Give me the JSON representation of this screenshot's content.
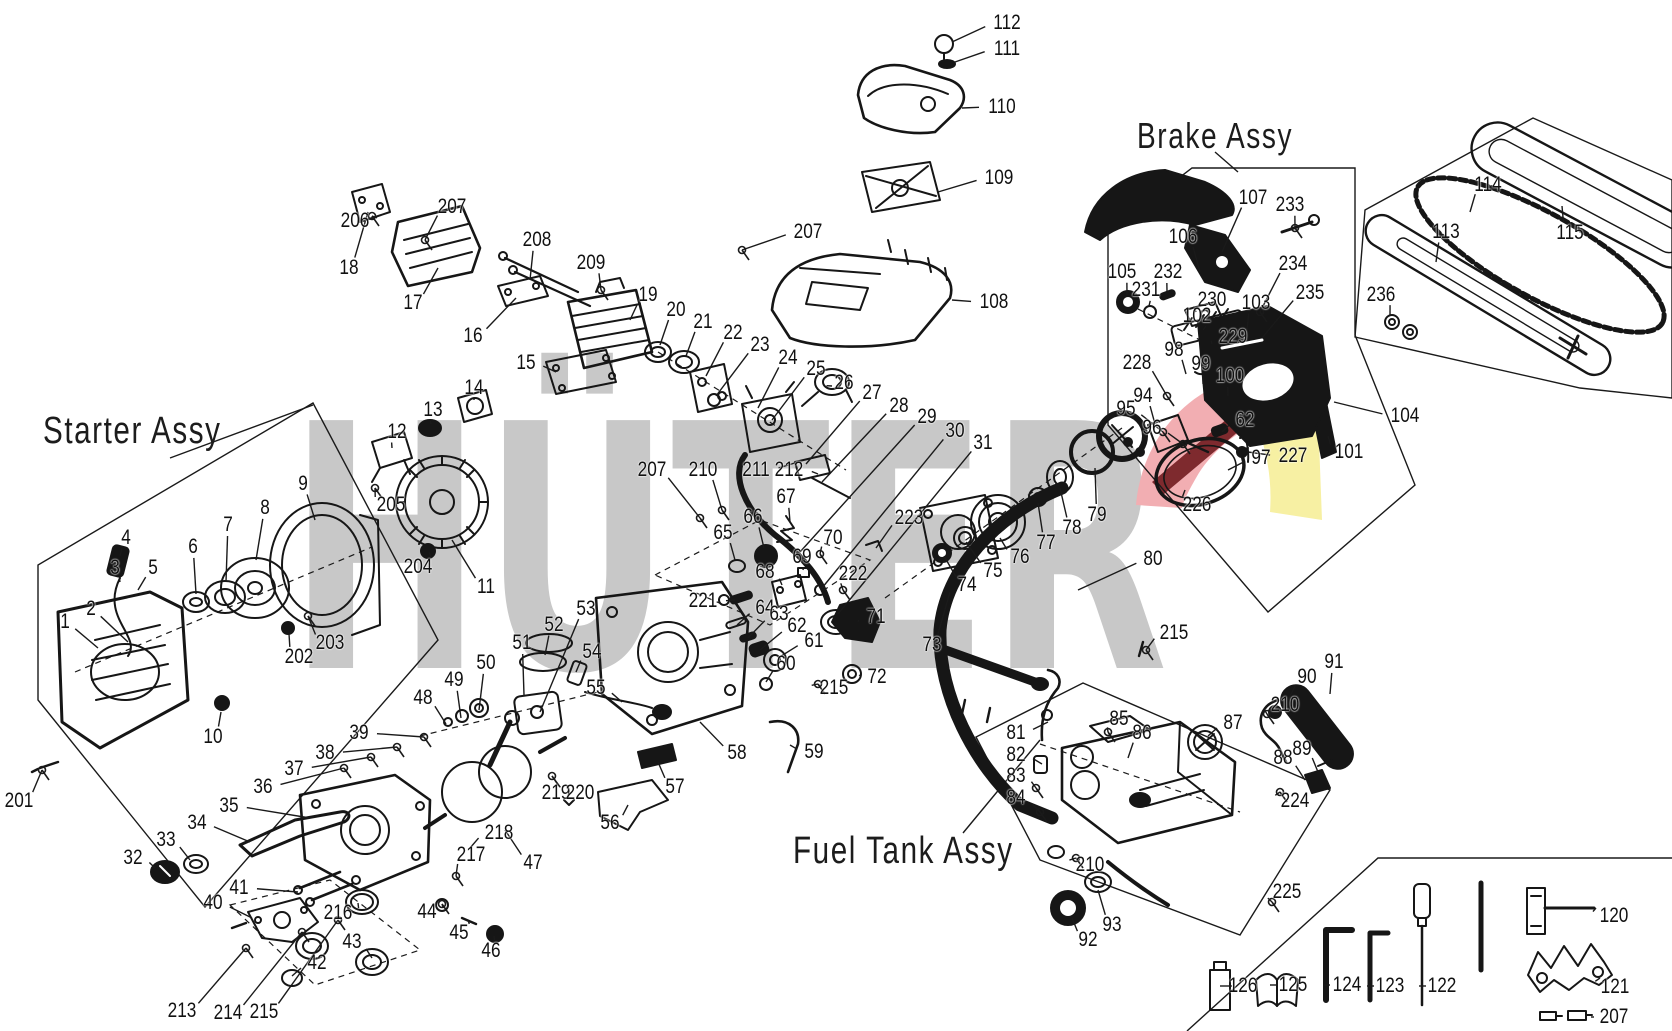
{
  "titles": {
    "starter": "Starter Assy",
    "brake": "Brake Assy",
    "fuel": "Fuel Tank Assy"
  },
  "watermark": {
    "text": "HÜTER"
  },
  "colors": {
    "watermark_gray": "#c8c8c8",
    "accent_red_light": "#f2aeb2",
    "accent_red_dark": "#7e2a2e",
    "accent_yellow": "#f7f0a3",
    "line": "#1a1a1a"
  },
  "callouts": [
    {
      "n": "1",
      "x": 65,
      "y": 622,
      "tx": 98,
      "ty": 648
    },
    {
      "n": "2",
      "x": 91,
      "y": 609,
      "tx": 128,
      "ty": 642
    },
    {
      "n": "3",
      "x": 115,
      "y": 568,
      "tx": 120,
      "ty": 582
    },
    {
      "n": "4",
      "x": 126,
      "y": 538,
      "tx": 120,
      "ty": 556
    },
    {
      "n": "5",
      "x": 153,
      "y": 568,
      "tx": 138,
      "ty": 590
    },
    {
      "n": "6",
      "x": 193,
      "y": 547,
      "tx": 196,
      "ty": 594
    },
    {
      "n": "7",
      "x": 228,
      "y": 525,
      "tx": 226,
      "ty": 582
    },
    {
      "n": "8",
      "x": 265,
      "y": 508,
      "tx": 256,
      "ty": 560
    },
    {
      "n": "9",
      "x": 303,
      "y": 484,
      "tx": 315,
      "ty": 520
    },
    {
      "n": "10",
      "x": 213,
      "y": 737,
      "tx": 221,
      "ty": 712
    },
    {
      "n": "11",
      "x": 486,
      "y": 587,
      "tx": 452,
      "ty": 540
    },
    {
      "n": "12",
      "x": 397,
      "y": 432,
      "tx": 392,
      "ty": 448
    },
    {
      "n": "13",
      "x": 433,
      "y": 410,
      "tx": 431,
      "ty": 424
    },
    {
      "n": "14",
      "x": 474,
      "y": 388,
      "tx": 474,
      "ty": 400
    },
    {
      "n": "201",
      "x": 19,
      "y": 801,
      "tx": 42,
      "ty": 770,
      "s": 1
    },
    {
      "n": "202",
      "x": 299,
      "y": 657,
      "tx": 289,
      "ty": 634
    },
    {
      "n": "203",
      "x": 330,
      "y": 643,
      "tx": 308,
      "ty": 616,
      "s": 1
    },
    {
      "n": "204",
      "x": 418,
      "y": 567,
      "tx": 429,
      "ty": 552
    },
    {
      "n": "205",
      "x": 391,
      "y": 505,
      "tx": 375,
      "ty": 488,
      "s": 1
    },
    {
      "n": "206",
      "x": 355,
      "y": 221,
      "tx": 372,
      "ty": 216,
      "s": 1
    },
    {
      "n": "207",
      "x": 452,
      "y": 207,
      "tx": 425,
      "ty": 240,
      "s": 1
    },
    {
      "n": "18",
      "x": 349,
      "y": 268,
      "tx": 368,
      "ty": 212
    },
    {
      "n": "17",
      "x": 413,
      "y": 303,
      "tx": 438,
      "ty": 268
    },
    {
      "n": "208",
      "x": 537,
      "y": 240,
      "tx": 530,
      "ty": 280
    },
    {
      "n": "16",
      "x": 473,
      "y": 336,
      "tx": 516,
      "ty": 298
    },
    {
      "n": "209",
      "x": 591,
      "y": 263,
      "tx": 601,
      "ty": 290,
      "s": 1
    },
    {
      "n": "19",
      "x": 648,
      "y": 295,
      "tx": 630,
      "ty": 320
    },
    {
      "n": "20",
      "x": 676,
      "y": 310,
      "tx": 660,
      "ty": 345
    },
    {
      "n": "21",
      "x": 703,
      "y": 322,
      "tx": 686,
      "ty": 356
    },
    {
      "n": "15",
      "x": 526,
      "y": 363,
      "tx": 556,
      "ty": 372
    },
    {
      "n": "22",
      "x": 733,
      "y": 333,
      "tx": 706,
      "ty": 376
    },
    {
      "n": "23",
      "x": 760,
      "y": 345,
      "tx": 716,
      "ty": 396
    },
    {
      "n": "24",
      "x": 788,
      "y": 358,
      "tx": 758,
      "ty": 408
    },
    {
      "n": "25",
      "x": 816,
      "y": 369,
      "tx": 772,
      "ty": 420
    },
    {
      "n": "26",
      "x": 844,
      "y": 383,
      "tx": 832,
      "ty": 386
    },
    {
      "n": "27",
      "x": 872,
      "y": 393,
      "tx": 806,
      "ty": 464
    },
    {
      "n": "28",
      "x": 899,
      "y": 406,
      "tx": 822,
      "ty": 482
    },
    {
      "n": "29",
      "x": 927,
      "y": 417,
      "tx": 800,
      "ty": 552
    },
    {
      "n": "30",
      "x": 955,
      "y": 431,
      "tx": 822,
      "ty": 588
    },
    {
      "n": "31",
      "x": 983,
      "y": 443,
      "tx": 838,
      "ty": 614
    },
    {
      "n": "108",
      "x": 994,
      "y": 302,
      "tx": 952,
      "ty": 300
    },
    {
      "n": "207",
      "x": 808,
      "y": 232,
      "tx": 742,
      "ty": 250,
      "s": 1
    },
    {
      "n": "109",
      "x": 999,
      "y": 178,
      "tx": 938,
      "ty": 192
    },
    {
      "n": "110",
      "x": 1002,
      "y": 107,
      "tx": 962,
      "ty": 108
    },
    {
      "n": "112",
      "x": 1007,
      "y": 23,
      "tx": 952,
      "ty": 42
    },
    {
      "n": "111",
      "x": 1007,
      "y": 49,
      "tx": 955,
      "ty": 62
    },
    {
      "n": "207",
      "x": 652,
      "y": 470,
      "tx": 700,
      "ty": 518,
      "s": 1
    },
    {
      "n": "210",
      "x": 703,
      "y": 470,
      "tx": 722,
      "ty": 510,
      "s": 1
    },
    {
      "n": "211",
      "x": 756,
      "y": 470,
      "tx": 798,
      "ty": 462
    },
    {
      "n": "212",
      "x": 789,
      "y": 470,
      "tx": 818,
      "ty": 474
    },
    {
      "n": "65",
      "x": 723,
      "y": 533,
      "tx": 735,
      "ty": 560
    },
    {
      "n": "66",
      "x": 753,
      "y": 517,
      "tx": 764,
      "ty": 548
    },
    {
      "n": "67",
      "x": 786,
      "y": 497,
      "tx": 790,
      "ty": 522
    },
    {
      "n": "70",
      "x": 833,
      "y": 538,
      "tx": 820,
      "ty": 554,
      "s": 1
    },
    {
      "n": "69",
      "x": 802,
      "y": 557,
      "tx": 803,
      "ty": 570
    },
    {
      "n": "68",
      "x": 765,
      "y": 572,
      "tx": 782,
      "ty": 585
    },
    {
      "n": "221",
      "x": 703,
      "y": 601,
      "tx": 735,
      "ty": 600
    },
    {
      "n": "64",
      "x": 765,
      "y": 608,
      "tx": 737,
      "ty": 625
    },
    {
      "n": "63",
      "x": 779,
      "y": 614,
      "tx": 748,
      "ty": 638
    },
    {
      "n": "62",
      "x": 797,
      "y": 626,
      "tx": 760,
      "ty": 650
    },
    {
      "n": "61",
      "x": 814,
      "y": 641,
      "tx": 778,
      "ty": 658
    },
    {
      "n": "60",
      "x": 786,
      "y": 664,
      "tx": 766,
      "ty": 682
    },
    {
      "n": "222",
      "x": 853,
      "y": 574,
      "tx": 843,
      "ty": 590,
      "s": 1
    },
    {
      "n": "71",
      "x": 876,
      "y": 617,
      "tx": 858,
      "ty": 622
    },
    {
      "n": "72",
      "x": 877,
      "y": 677,
      "tx": 860,
      "ty": 675
    },
    {
      "n": "215",
      "x": 834,
      "y": 688,
      "tx": 818,
      "ty": 684,
      "s": 1
    },
    {
      "n": "59",
      "x": 814,
      "y": 752,
      "tx": 790,
      "ty": 745
    },
    {
      "n": "58",
      "x": 737,
      "y": 753,
      "tx": 700,
      "ty": 722
    },
    {
      "n": "223",
      "x": 909,
      "y": 518,
      "tx": 876,
      "ty": 548
    },
    {
      "n": "56",
      "x": 610,
      "y": 823,
      "tx": 628,
      "ty": 805
    },
    {
      "n": "57",
      "x": 675,
      "y": 787,
      "tx": 658,
      "ty": 762
    },
    {
      "n": "48",
      "x": 423,
      "y": 698,
      "tx": 446,
      "ty": 724
    },
    {
      "n": "49",
      "x": 454,
      "y": 680,
      "tx": 461,
      "ty": 718
    },
    {
      "n": "50",
      "x": 486,
      "y": 663,
      "tx": 479,
      "ty": 710
    },
    {
      "n": "51",
      "x": 522,
      "y": 643,
      "tx": 524,
      "ty": 695
    },
    {
      "n": "52",
      "x": 554,
      "y": 625,
      "tx": 545,
      "ty": 655
    },
    {
      "n": "53",
      "x": 586,
      "y": 609,
      "tx": 540,
      "ty": 712
    },
    {
      "n": "54",
      "x": 592,
      "y": 652,
      "tx": 576,
      "ty": 672
    },
    {
      "n": "55",
      "x": 596,
      "y": 688,
      "tx": 622,
      "ty": 702
    },
    {
      "n": "47",
      "x": 533,
      "y": 863,
      "tx": 505,
      "ty": 830
    },
    {
      "n": "218",
      "x": 499,
      "y": 833,
      "tx": 470,
      "ty": 848
    },
    {
      "n": "219",
      "x": 556,
      "y": 793
    },
    {
      "n": "220",
      "x": 580,
      "y": 793,
      "tx": 552,
      "ty": 776,
      "s": 1
    },
    {
      "n": "32",
      "x": 133,
      "y": 858,
      "tx": 155,
      "ty": 868
    },
    {
      "n": "33",
      "x": 166,
      "y": 840,
      "tx": 190,
      "ty": 860
    },
    {
      "n": "34",
      "x": 197,
      "y": 823,
      "tx": 250,
      "ty": 842
    },
    {
      "n": "35",
      "x": 229,
      "y": 806,
      "tx": 310,
      "ty": 818
    },
    {
      "n": "36",
      "x": 263,
      "y": 787,
      "tx": 344,
      "ty": 768,
      "s": 1
    },
    {
      "n": "37",
      "x": 294,
      "y": 769,
      "tx": 371,
      "ty": 757,
      "s": 1
    },
    {
      "n": "38",
      "x": 325,
      "y": 753,
      "tx": 397,
      "ty": 747,
      "s": 1
    },
    {
      "n": "39",
      "x": 359,
      "y": 733,
      "tx": 424,
      "ty": 737,
      "s": 1
    },
    {
      "n": "40",
      "x": 213,
      "y": 903,
      "tx": 252,
      "ty": 918
    },
    {
      "n": "41",
      "x": 239,
      "y": 888,
      "tx": 298,
      "ty": 892
    },
    {
      "n": "216",
      "x": 338,
      "y": 913,
      "tx": 358,
      "ty": 903
    },
    {
      "n": "42",
      "x": 317,
      "y": 963,
      "tx": 292,
      "ty": 976
    },
    {
      "n": "43",
      "x": 352,
      "y": 942,
      "tx": 372,
      "ty": 958
    },
    {
      "n": "44",
      "x": 427,
      "y": 912,
      "tx": 442,
      "ty": 904,
      "s": 1
    },
    {
      "n": "45",
      "x": 459,
      "y": 933,
      "tx": 468,
      "ty": 920
    },
    {
      "n": "46",
      "x": 491,
      "y": 951,
      "tx": 494,
      "ty": 936
    },
    {
      "n": "213",
      "x": 182,
      "y": 1011,
      "tx": 246,
      "ty": 948,
      "s": 1
    },
    {
      "n": "214",
      "x": 228,
      "y": 1013,
      "tx": 302,
      "ty": 932,
      "s": 1
    },
    {
      "n": "215",
      "x": 264,
      "y": 1012,
      "tx": 338,
      "ty": 920,
      "s": 1
    },
    {
      "n": "217",
      "x": 471,
      "y": 855,
      "tx": 456,
      "ty": 876,
      "s": 1
    },
    {
      "n": "73",
      "x": 932,
      "y": 645,
      "tx": 950,
      "ty": 592
    },
    {
      "n": "74",
      "x": 967,
      "y": 585,
      "tx": 944,
      "ty": 556
    },
    {
      "n": "75",
      "x": 993,
      "y": 571,
      "tx": 966,
      "ty": 542
    },
    {
      "n": "76",
      "x": 1020,
      "y": 557,
      "tx": 1000,
      "ty": 538
    },
    {
      "n": "77",
      "x": 1046,
      "y": 543,
      "tx": 1038,
      "ty": 503
    },
    {
      "n": "78",
      "x": 1072,
      "y": 528,
      "tx": 1060,
      "ty": 488
    },
    {
      "n": "79",
      "x": 1097,
      "y": 515,
      "tx": 1095,
      "ty": 468
    },
    {
      "n": "80",
      "x": 1153,
      "y": 559,
      "tx": 1078,
      "ty": 590
    },
    {
      "n": "105",
      "x": 1122,
      "y": 272,
      "tx": 1127,
      "ty": 295
    },
    {
      "n": "231",
      "x": 1146,
      "y": 290,
      "tx": 1149,
      "ty": 306
    },
    {
      "n": "232",
      "x": 1168,
      "y": 272,
      "tx": 1167,
      "ty": 292
    },
    {
      "n": "106",
      "x": 1183,
      "y": 237,
      "tx": 1200,
      "ty": 272
    },
    {
      "n": "107",
      "x": 1253,
      "y": 198,
      "tx": 1222,
      "ty": 252
    },
    {
      "n": "233",
      "x": 1290,
      "y": 205,
      "tx": 1295,
      "ty": 228,
      "s": 1
    },
    {
      "n": "230",
      "x": 1212,
      "y": 300,
      "tx": 1196,
      "ty": 312
    },
    {
      "n": "102",
      "x": 1197,
      "y": 316,
      "tx": 1203,
      "ty": 330
    },
    {
      "n": "234",
      "x": 1293,
      "y": 264,
      "tx": 1260,
      "ty": 312,
      "s": 1
    },
    {
      "n": "103",
      "x": 1256,
      "y": 303,
      "tx": 1247,
      "ty": 330
    },
    {
      "n": "235",
      "x": 1310,
      "y": 293,
      "tx": 1262,
      "ty": 338
    },
    {
      "n": "229",
      "x": 1233,
      "y": 337,
      "tx": 1212,
      "ty": 344
    },
    {
      "n": "98",
      "x": 1174,
      "y": 350,
      "tx": 1186,
      "ty": 374
    },
    {
      "n": "99",
      "x": 1201,
      "y": 364,
      "tx": 1203,
      "ty": 384
    },
    {
      "n": "228",
      "x": 1137,
      "y": 363,
      "tx": 1167,
      "ty": 396,
      "s": 1
    },
    {
      "n": "100",
      "x": 1230,
      "y": 376,
      "tx": 1228,
      "ty": 396
    },
    {
      "n": "94",
      "x": 1143,
      "y": 396,
      "tx": 1155,
      "ty": 424
    },
    {
      "n": "95",
      "x": 1126,
      "y": 409,
      "tx": 1163,
      "ty": 432,
      "s": 1
    },
    {
      "n": "96",
      "x": 1152,
      "y": 428,
      "tx": 1183,
      "ty": 444,
      "s": 1
    },
    {
      "n": "97",
      "x": 1261,
      "y": 458,
      "tx": 1228,
      "ty": 470
    },
    {
      "n": "226",
      "x": 1197,
      "y": 505,
      "tx": 1185,
      "ty": 490
    },
    {
      "n": "227",
      "x": 1293,
      "y": 456,
      "tx": 1248,
      "ty": 452
    },
    {
      "n": "62",
      "x": 1245,
      "y": 420,
      "tx": 1222,
      "ty": 432
    },
    {
      "n": "101",
      "x": 1349,
      "y": 452,
      "tx": 1328,
      "ty": 436
    },
    {
      "n": "104",
      "x": 1405,
      "y": 416,
      "tx": 1334,
      "ty": 402
    },
    {
      "n": "114",
      "x": 1488,
      "y": 185,
      "tx": 1470,
      "ty": 212
    },
    {
      "n": "113",
      "x": 1446,
      "y": 232,
      "tx": 1436,
      "ty": 262
    },
    {
      "n": "115",
      "x": 1570,
      "y": 233,
      "tx": 1562,
      "ty": 206
    },
    {
      "n": "236",
      "x": 1381,
      "y": 295,
      "tx": 1390,
      "ty": 316
    },
    {
      "n": "81",
      "x": 1016,
      "y": 733,
      "tx": 1048,
      "ty": 722
    },
    {
      "n": "82",
      "x": 1016,
      "y": 755,
      "tx": 1042,
      "ty": 764
    },
    {
      "n": "83",
      "x": 1016,
      "y": 776,
      "tx": 1036,
      "ty": 788,
      "s": 1
    },
    {
      "n": "84",
      "x": 1016,
      "y": 798,
      "tx": 1040,
      "ty": 812,
      "s": 1
    },
    {
      "n": "85",
      "x": 1119,
      "y": 719,
      "tx": 1108,
      "ty": 732,
      "s": 1
    },
    {
      "n": "86",
      "x": 1142,
      "y": 733,
      "tx": 1128,
      "ty": 758
    },
    {
      "n": "87",
      "x": 1233,
      "y": 723,
      "tx": 1208,
      "ty": 736
    },
    {
      "n": "210",
      "x": 1285,
      "y": 705,
      "tx": 1267,
      "ty": 714,
      "s": 1
    },
    {
      "n": "90",
      "x": 1307,
      "y": 677,
      "tx": 1288,
      "ty": 700
    },
    {
      "n": "91",
      "x": 1334,
      "y": 662,
      "tx": 1330,
      "ty": 694
    },
    {
      "n": "88",
      "x": 1283,
      "y": 758,
      "tx": 1305,
      "ty": 780
    },
    {
      "n": "89",
      "x": 1302,
      "y": 749,
      "tx": 1318,
      "ty": 772
    },
    {
      "n": "224",
      "x": 1295,
      "y": 801,
      "tx": 1280,
      "ty": 792,
      "s": 1
    },
    {
      "n": "215",
      "x": 1174,
      "y": 633,
      "tx": 1146,
      "ty": 650,
      "s": 1
    },
    {
      "n": "92",
      "x": 1088,
      "y": 940,
      "tx": 1072,
      "ty": 918
    },
    {
      "n": "93",
      "x": 1112,
      "y": 925,
      "tx": 1098,
      "ty": 890
    },
    {
      "n": "210",
      "x": 1090,
      "y": 865,
      "tx": 1076,
      "ty": 858,
      "s": 1
    },
    {
      "n": "225",
      "x": 1287,
      "y": 892,
      "tx": 1272,
      "ty": 902,
      "s": 1
    },
    {
      "n": "126",
      "x": 1243,
      "y": 986,
      "tx": 1232,
      "ty": 986
    },
    {
      "n": "125",
      "x": 1293,
      "y": 985,
      "tx": 1278,
      "ty": 985
    },
    {
      "n": "124",
      "x": 1347,
      "y": 985,
      "tx": 1330,
      "ty": 985
    },
    {
      "n": "123",
      "x": 1390,
      "y": 986,
      "tx": 1374,
      "ty": 986
    },
    {
      "n": "122",
      "x": 1442,
      "y": 986,
      "tx": 1426,
      "ty": 986
    },
    {
      "n": "120",
      "x": 1614,
      "y": 916,
      "tx": 1596,
      "ty": 908
    },
    {
      "n": "121",
      "x": 1615,
      "y": 987,
      "tx": 1600,
      "ty": 978
    },
    {
      "n": "207",
      "x": 1614,
      "y": 1017,
      "tx": 1594,
      "ty": 1017
    }
  ]
}
